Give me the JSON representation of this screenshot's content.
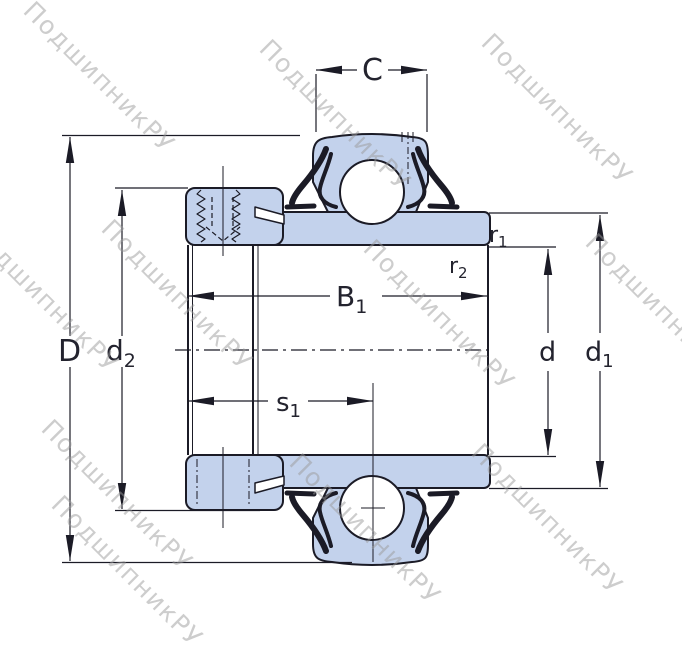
{
  "watermark": {
    "text": "ПодшипникРУ"
  },
  "colors": {
    "fill": "#c3d2ec",
    "line": "#1b1b26",
    "watermark": "#9a9a9a",
    "background": "#ffffff"
  },
  "labels": {
    "C": {
      "main": "C"
    },
    "D": {
      "main": "D"
    },
    "d2": {
      "main": "d",
      "sub": "2"
    },
    "B1": {
      "main": "B",
      "sub": "1"
    },
    "s1": {
      "main": "s",
      "sub": "1"
    },
    "r1": {
      "main": "r",
      "sub": "1"
    },
    "r2": {
      "main": "r",
      "sub": "2"
    },
    "d": {
      "main": "d"
    },
    "d1": {
      "main": "d",
      "sub": "1"
    }
  }
}
